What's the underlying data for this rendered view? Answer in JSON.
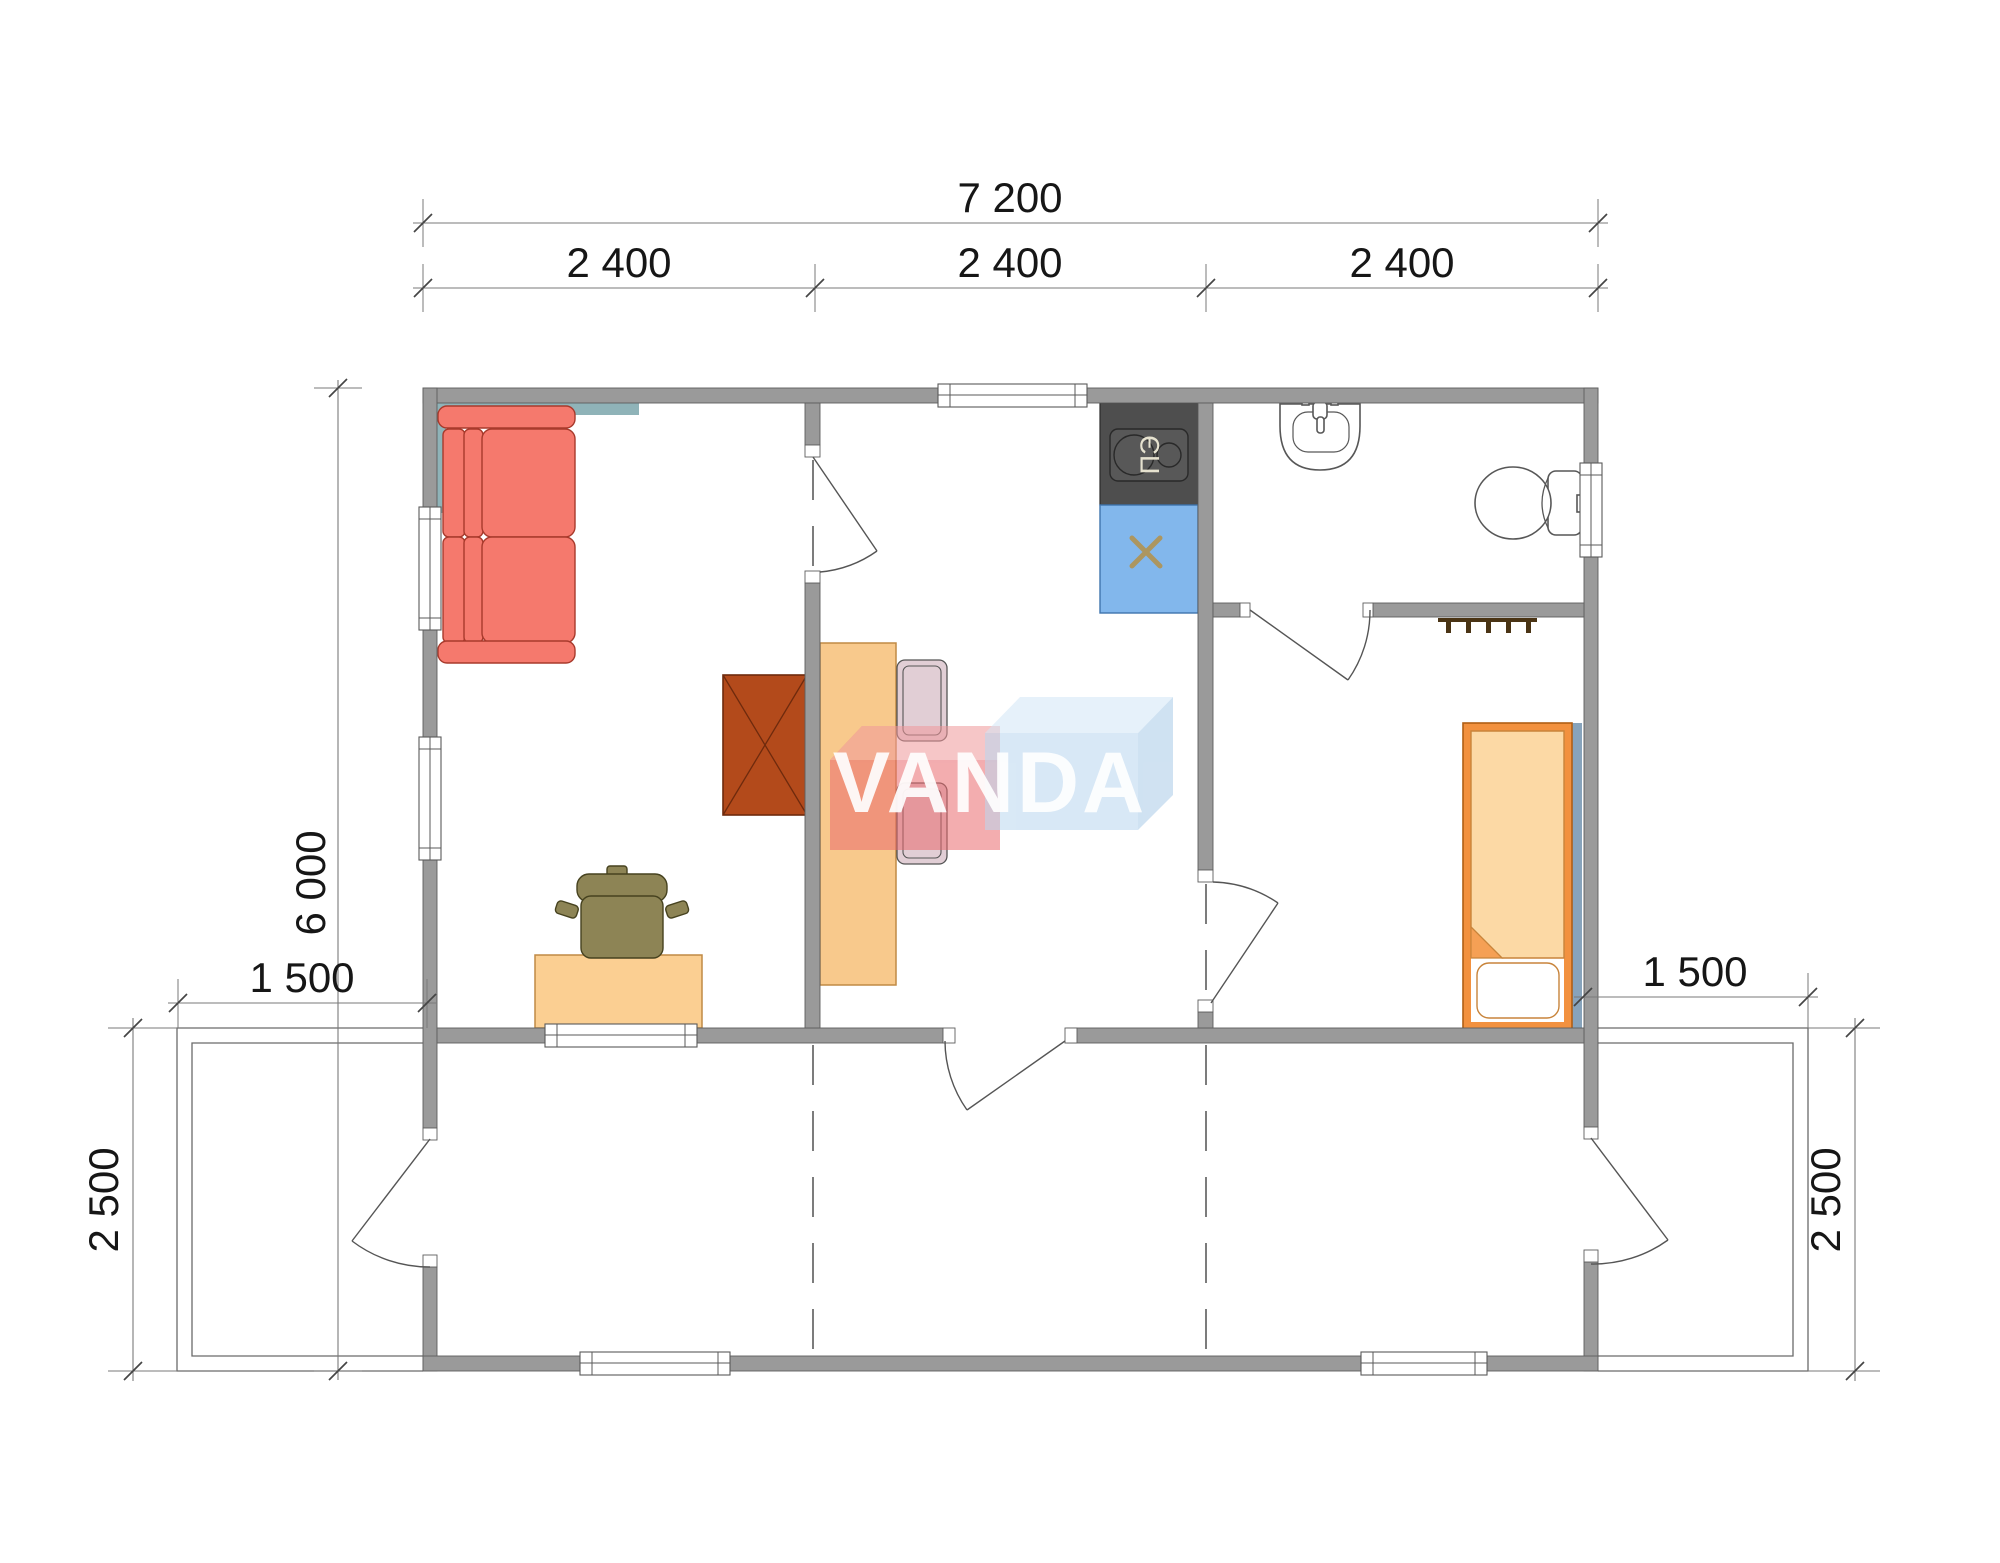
{
  "watermark": {
    "text": "VANDA"
  },
  "equipment_labels": {
    "stove": "ПЭ"
  },
  "dimensions": {
    "top_total": "7 200",
    "top_modules": [
      "2 400",
      "2 400",
      "2 400"
    ],
    "left_depth": "6 000",
    "left_terrace_width": "1 500",
    "right_terrace_width": "1 500",
    "left_terrace_depth": "2 500",
    "right_terrace_depth": "2 500"
  },
  "colors": {
    "wall": "#9a9a9a",
    "sofa": "#f5796d",
    "sofa_outline": "#a83a2c",
    "teal_backing": "#8fb3b8",
    "table": "#f8c98c",
    "desk": "#fbcf92",
    "furniture_edge": "#c08a45",
    "cabinet_brown": "#b34a1b",
    "cabinet_brown_edge": "#6e2a0d",
    "chair_olive": "#8d8455",
    "chair_olive_edge": "#46421f",
    "dining_chair": "#d9c2cb",
    "stove_dark": "#4e4e4e",
    "stove_inner": "#585858",
    "sink_blue": "#82b7ec",
    "sink_blue_edge": "#3f74ad",
    "sink_cross": "#ac9660",
    "bed_frame_orange": "#f2913f",
    "bed_frame_edge": "#b05f15",
    "bed_blanket": "#fcd9a5",
    "bed_blanket_edge": "#c8843b",
    "bed_fold": "#f5a055",
    "bed_backing": "#87a3bb",
    "hooks_brown": "#4a3415",
    "logo_red": "#e96a6e",
    "logo_red_top": "#f0989b",
    "logo_blue": "#b9d7ef",
    "logo_blue_top": "#d3e6f6",
    "logo_blue_side": "#a9cbe8",
    "logo_text": "#ffffff"
  }
}
